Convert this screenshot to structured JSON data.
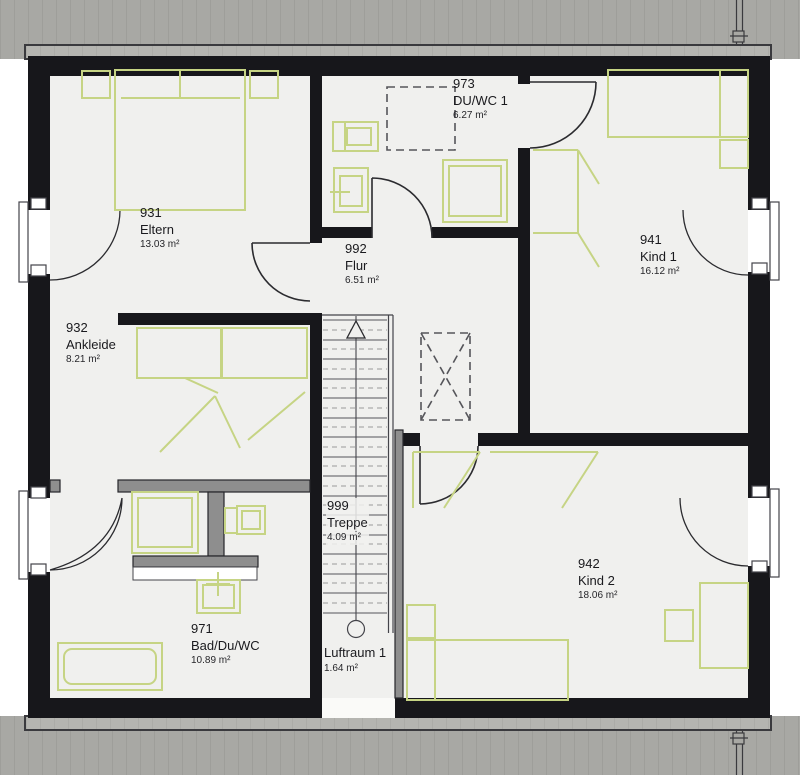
{
  "plan_type": "floor-plan-upper-storey",
  "rooms": {
    "eltern": {
      "number": "931",
      "name": "Eltern",
      "area": "13.03 m²"
    },
    "ankleide": {
      "number": "932",
      "name": "Ankleide",
      "area": "8.21 m²"
    },
    "bad": {
      "number": "971",
      "name": "Bad/Du/WC",
      "area": "10.89 m²"
    },
    "duwc": {
      "number": "973",
      "name": "DU/WC 1",
      "area": "6.27 m²"
    },
    "flur": {
      "number": "992",
      "name": "Flur",
      "area": "6.51 m²"
    },
    "treppe": {
      "number": "999",
      "name": "Treppe",
      "area": "4.09 m²"
    },
    "luftraum": {
      "number": "",
      "name": "Luftraum 1",
      "area": "1.64 m²"
    },
    "kind1": {
      "number": "941",
      "name": "Kind 1",
      "area": "16.12 m²"
    },
    "kind2": {
      "number": "942",
      "name": "Kind 2",
      "area": "18.06 m²"
    }
  },
  "colors": {
    "wall_black": "#17171b",
    "roof_band": "#a8a8a4",
    "roof_strip": "#b5b5b1",
    "floor": "#f0f0ee",
    "furniture_green": "#c6d484",
    "partition_gray": "#8e8e8e"
  }
}
